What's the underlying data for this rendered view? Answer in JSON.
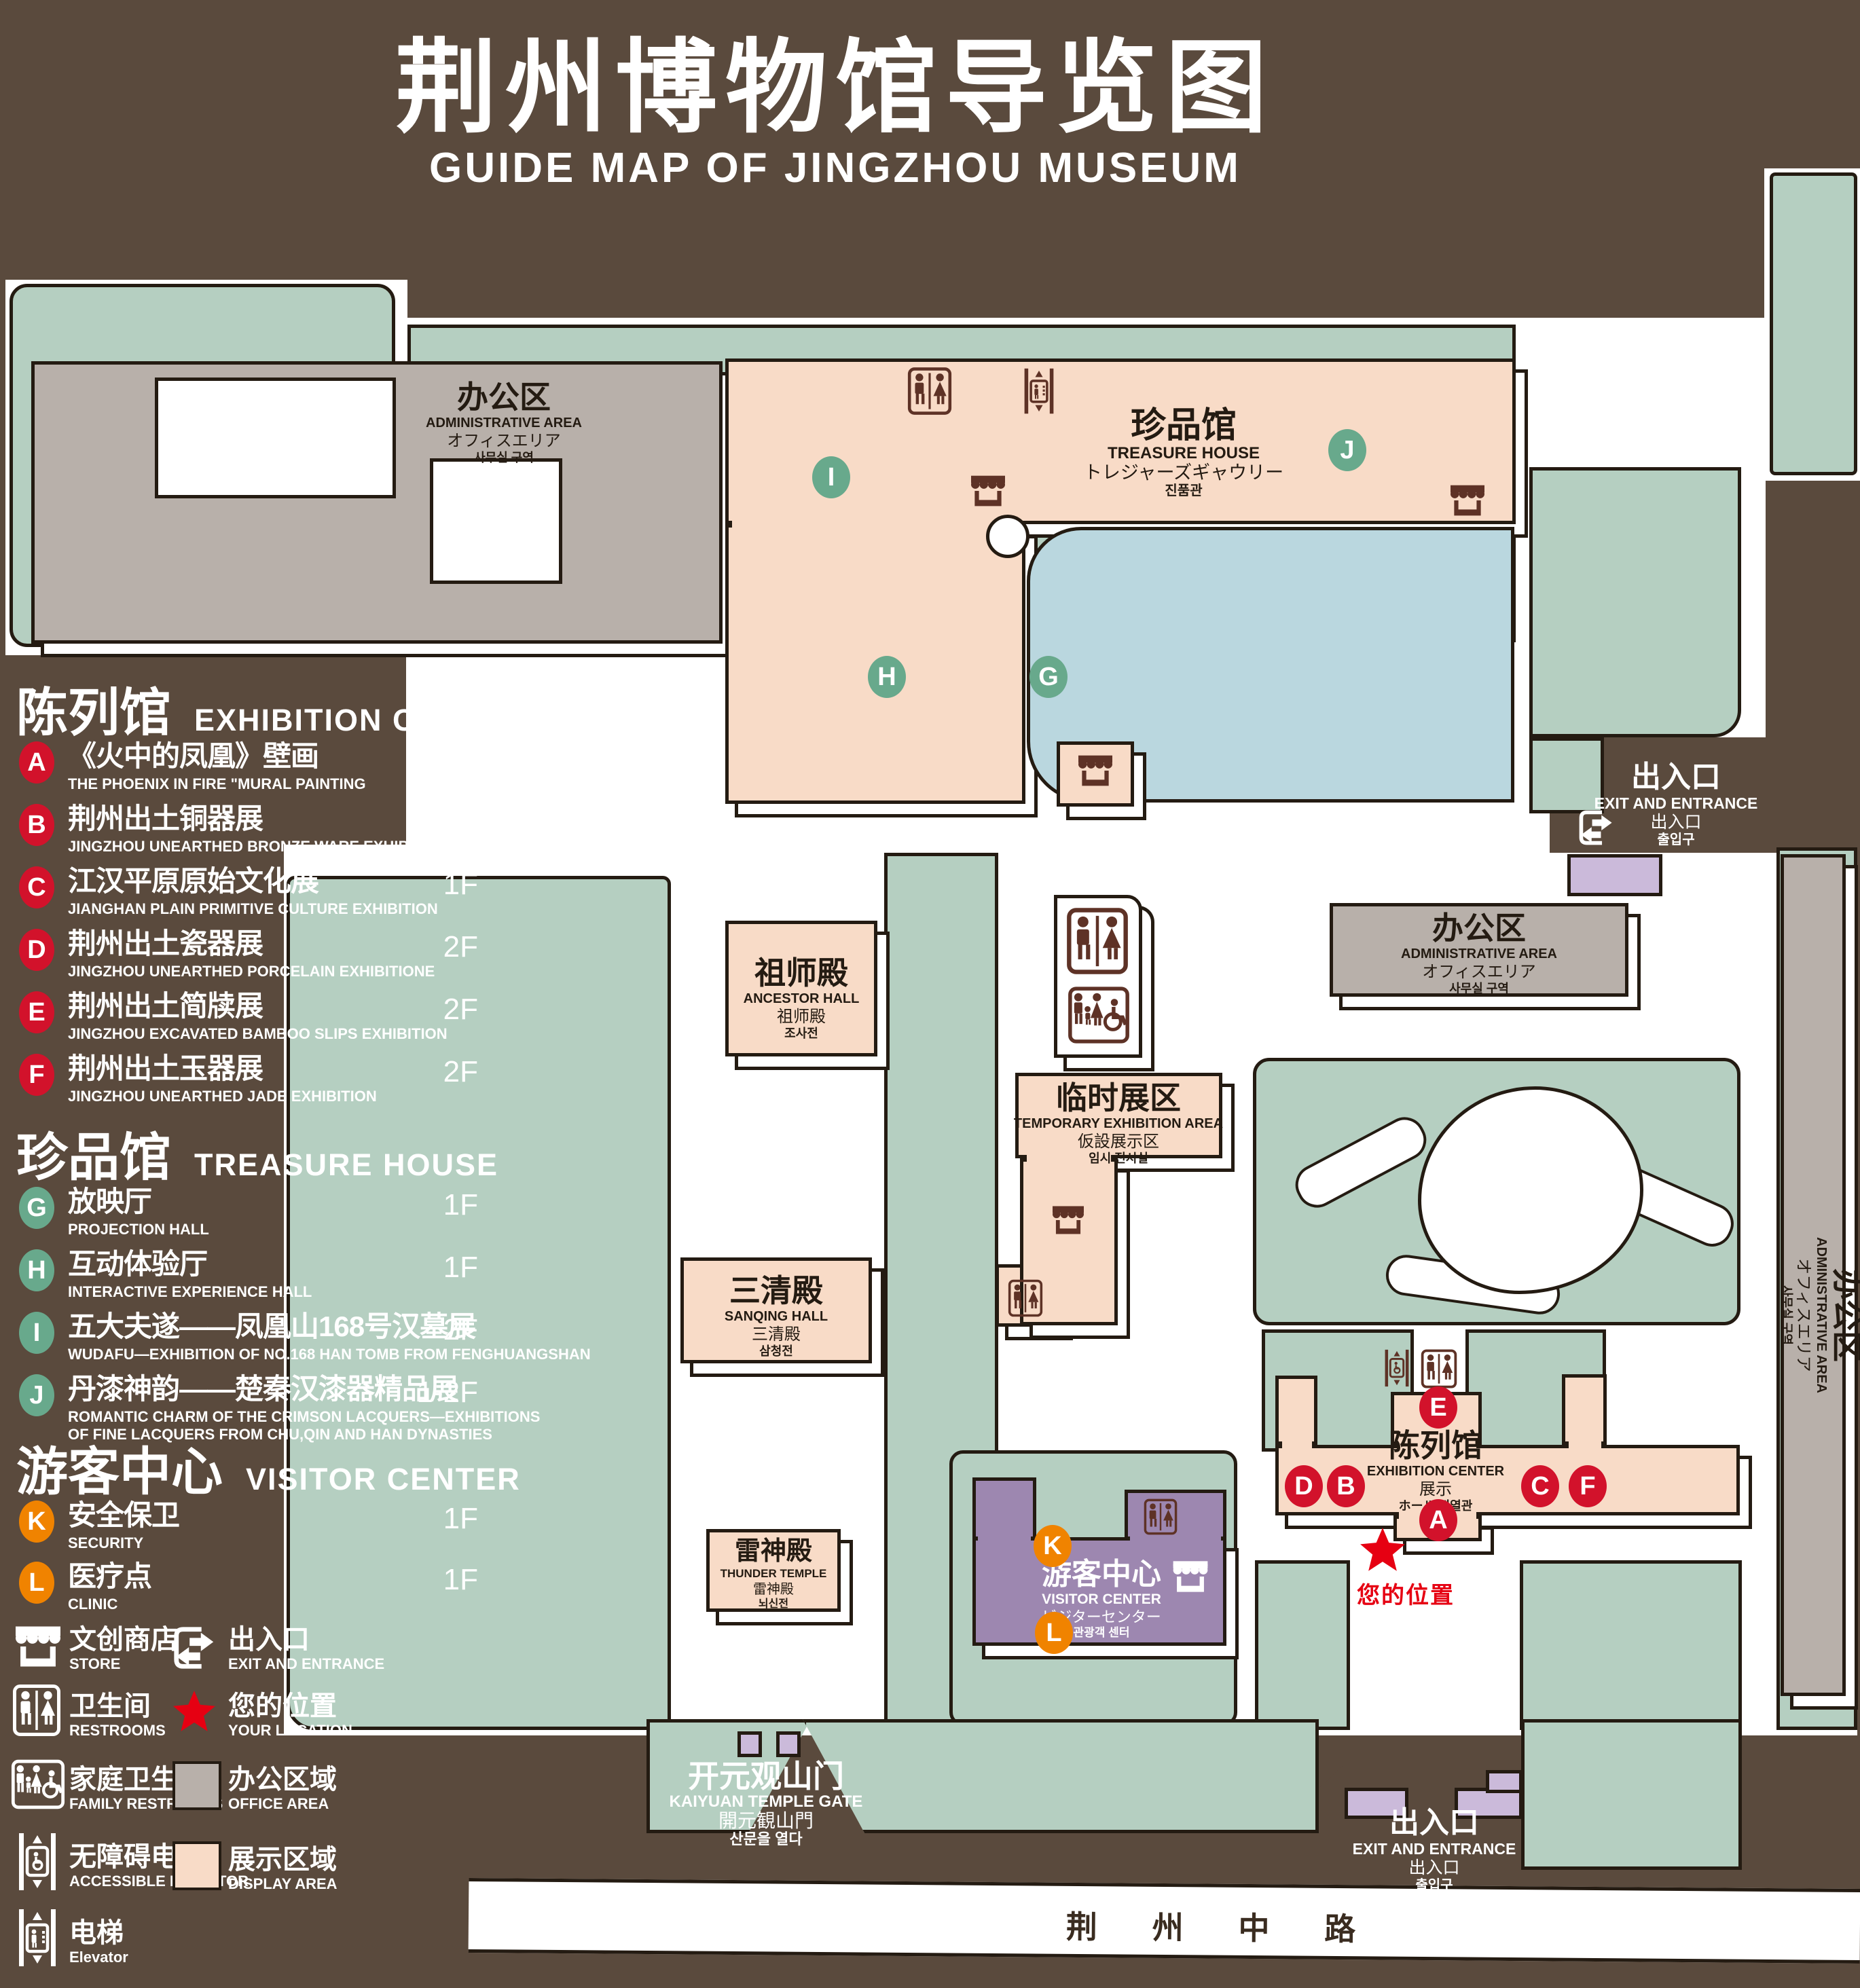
{
  "title": {
    "zh": "荆州博物馆导览图",
    "en": "GUIDE MAP OF JINGZHOU MUSEUM"
  },
  "colors": {
    "background": "#5a4a3d",
    "lawn": "#b5cfc1",
    "display_area": "#f8dbc7",
    "office_area": "#b8b0aa",
    "visitor_center": "#9d87b0",
    "gate_building": "#cbbada",
    "lake": "#bad7df",
    "badge_red": "#d2122b",
    "badge_green": "#68a98c",
    "badge_orange": "#f08300",
    "location_red": "#e60012",
    "map_icon_brown": "#5e3226"
  },
  "legend": {
    "sections": [
      {
        "title_zh": "陈列馆",
        "title_en": "EXHIBITION CENTER",
        "badge_color": "#d2122b",
        "items": [
          {
            "letter": "A",
            "zh": "《火中的凤凰》壁画",
            "en": "THE PHOENIX IN FIRE \"MURAL PAINTING",
            "floor": "1F"
          },
          {
            "letter": "B",
            "zh": "荆州出土铜器展",
            "en": "JINGZHOU UNEARTHED BRONZE WARE EXHIBITION",
            "floor": "1F"
          },
          {
            "letter": "C",
            "zh": "江汉平原原始文化展",
            "en": "JIANGHAN PLAIN PRIMITIVE CULTURE EXHIBITION",
            "floor": "1F"
          },
          {
            "letter": "D",
            "zh": "荆州出土瓷器展",
            "en": "JINGZHOU UNEARTHED PORCELAIN EXHIBITIONE",
            "floor": "2F"
          },
          {
            "letter": "E",
            "zh": "荆州出土简牍展",
            "en": "JINGZHOU EXCAVATED BAMBOO SLIPS EXHIBITION",
            "floor": "2F"
          },
          {
            "letter": "F",
            "zh": "荆州出土玉器展",
            "en": "JINGZHOU UNEARTHED JADE EXHIBITION",
            "floor": "2F"
          }
        ]
      },
      {
        "title_zh": "珍品馆",
        "title_en": "TREASURE HOUSE",
        "badge_color": "#68a98c",
        "items": [
          {
            "letter": "G",
            "zh": "放映厅",
            "en": "PROJECTION HALL",
            "floor": "1F"
          },
          {
            "letter": "H",
            "zh": "互动体验厅",
            "en": "INTERACTIVE EXPERIENCE HALL",
            "floor": "1F"
          },
          {
            "letter": "I",
            "zh": "五大夫遂——凤凰山168号汉墓展",
            "en": "WUDAFU—EXHIBITION OF NO.168 HAN TOMB FROM FENGHUANGSHAN",
            "floor": "2F"
          },
          {
            "letter": "J",
            "zh": "丹漆神韵——楚秦汉漆器精品展",
            "en": "ROMANTIC CHARM OF THE CRIMSON LACQUERS—EXHIBITIONS",
            "en2": "OF FINE LACQUERS FROM CHU,QIN AND HAN DYNASTIES",
            "floor": "1-2F"
          }
        ]
      },
      {
        "title_zh": "游客中心",
        "title_en": "VISITOR CENTER",
        "badge_color": "#f08300",
        "items": [
          {
            "letter": "K",
            "zh": "安全保卫",
            "en": "SECURITY",
            "floor": "1F"
          },
          {
            "letter": "L",
            "zh": "医疗点",
            "en": "CLINIC",
            "floor": "1F"
          }
        ]
      }
    ],
    "symbols": [
      {
        "icon": "store-icon",
        "zh": "文创商店",
        "en": "STORE"
      },
      {
        "icon": "exit-icon",
        "zh": "出入口",
        "en": "EXIT AND ENTRANCE"
      },
      {
        "icon": "restrooms-icon",
        "zh": "卫生间",
        "en": "RESTROOMS"
      },
      {
        "icon": "your-location-star",
        "zh": "您的位置",
        "en": "YOUR LOCATION"
      },
      {
        "icon": "family-restrooms-icon",
        "zh": "家庭卫生间",
        "en": "FAMILY RESTROOMS"
      },
      {
        "icon": "office-area-swatch",
        "zh": "办公区域",
        "en": "OFFICE AREA"
      },
      {
        "icon": "accessible-elevator-icon",
        "zh": "无障碍电梯",
        "en": "ACCESSIBLE ELEVATOR"
      },
      {
        "icon": "display-area-swatch",
        "zh": "展示区域",
        "en": "DISPLAY AREA"
      },
      {
        "icon": "elevator-icon",
        "zh": "电梯",
        "en": "Elevator"
      }
    ]
  },
  "map": {
    "buildings": {
      "admin": {
        "zh": "办公区",
        "en": "ADMINISTRATIVE AREA",
        "ja": "オフィスエリア",
        "ko": "사무실 구역"
      },
      "treasure_house": {
        "zh": "珍品馆",
        "en": "TREASURE HOUSE",
        "ja": "トレジャーズギャウリー",
        "ko": "진품관"
      },
      "ancestor_hall": {
        "zh": "祖师殿",
        "en": "ANCESTOR HALL",
        "ja": "祖师殿",
        "ko": "조사전"
      },
      "temporary": {
        "zh": "临时展区",
        "en": "TEMPORARY EXHIBITION AREA",
        "ja": "仮設展示区",
        "ko": "임시 전시실"
      },
      "sanqing_hall": {
        "zh": "三清殿",
        "en": "SANQING HALL",
        "ja": "三清殿",
        "ko": "삼청전"
      },
      "thunder_temple": {
        "zh": "雷神殿",
        "en": "THUNDER TEMPLE",
        "ja": "雷神殿",
        "ko": "뇌신전"
      },
      "visitor_center": {
        "zh": "游客中心",
        "en": "VISITOR CENTER",
        "ja": "ビジターセンター",
        "ko": "관광객 센터"
      },
      "exhibition_center": {
        "zh": "陈列馆",
        "en": "EXHIBITION CENTER",
        "ja": "展示",
        "ko": "ホール 진열관"
      },
      "gate": {
        "zh": "开元观山门",
        "en": "KAIYUAN TEMPLE GATE",
        "ja": "開元観山門",
        "ko": "산문을 열다"
      },
      "exit": {
        "zh": "出入口",
        "en": "EXIT AND ENTRANCE",
        "ja": "出入口",
        "ko": "출입구"
      }
    },
    "road": {
      "name": "荆 州 中 路"
    },
    "your_location": "您的位置",
    "markers": {
      "A": "A",
      "B": "B",
      "C": "C",
      "D": "D",
      "E": "E",
      "F": "F",
      "G": "G",
      "H": "H",
      "I": "I",
      "J": "J",
      "K": "K",
      "L": "L"
    }
  }
}
